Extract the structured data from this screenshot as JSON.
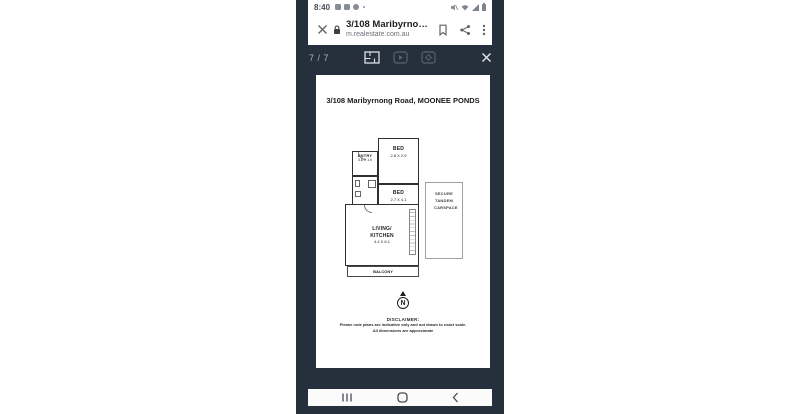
{
  "status_bar": {
    "time": "8:40",
    "left_icons": [
      "gallery-icon",
      "video-icon",
      "chrome-icon",
      "notification-dot"
    ],
    "right_icons": [
      "mute-icon",
      "wifi-icon",
      "signal-icon",
      "battery-icon"
    ]
  },
  "browser_header": {
    "close_icon": "close-icon",
    "lock_icon": "lock-icon",
    "title": "3/108 Maribyrno…",
    "url": "m.realestate.com.au",
    "action_icons": [
      "bookmark-icon",
      "share-icon",
      "overflow-menu-icon"
    ]
  },
  "gallery_toolbar": {
    "counter": "7 / 7",
    "media_icons": [
      "floorplan-icon",
      "video-icon",
      "virtual-tour-icon"
    ],
    "close_icon": "close-icon"
  },
  "floorplan": {
    "title": "3/108 Maribyrnong Road, MOONEE PONDS",
    "rooms": [
      {
        "name": "ENTRY",
        "dims": "3.8 X 1.0"
      },
      {
        "name": "BED",
        "dims": "2.8 X 2.9"
      },
      {
        "name": "BED",
        "dims": "2.7 X 4.1"
      },
      {
        "name": "LIVING/",
        "name2": "KITCHEN",
        "dims": "4.4 X 6.1"
      },
      {
        "name": "BALCONY"
      },
      {
        "name": "SECURE TANDEM CARSPACE"
      }
    ],
    "compass_label": "N",
    "disclaimer_heading": "DISCLAIMER:",
    "disclaimer_line1": "Please note plans are indicative only and not drawn to exact scale.",
    "disclaimer_line2": "All dimensions are approximate"
  },
  "nav_bar": {
    "icons": [
      "recents-icon",
      "home-icon",
      "back-icon"
    ]
  },
  "colors": {
    "app_dark": "#26303d",
    "surface": "#ffffff",
    "text_dark": "#202124",
    "text_gray": "#6b7076",
    "toolbar_dim": "#59626e",
    "toolbar_bright": "#dde1e6",
    "wall": "#303030"
  }
}
